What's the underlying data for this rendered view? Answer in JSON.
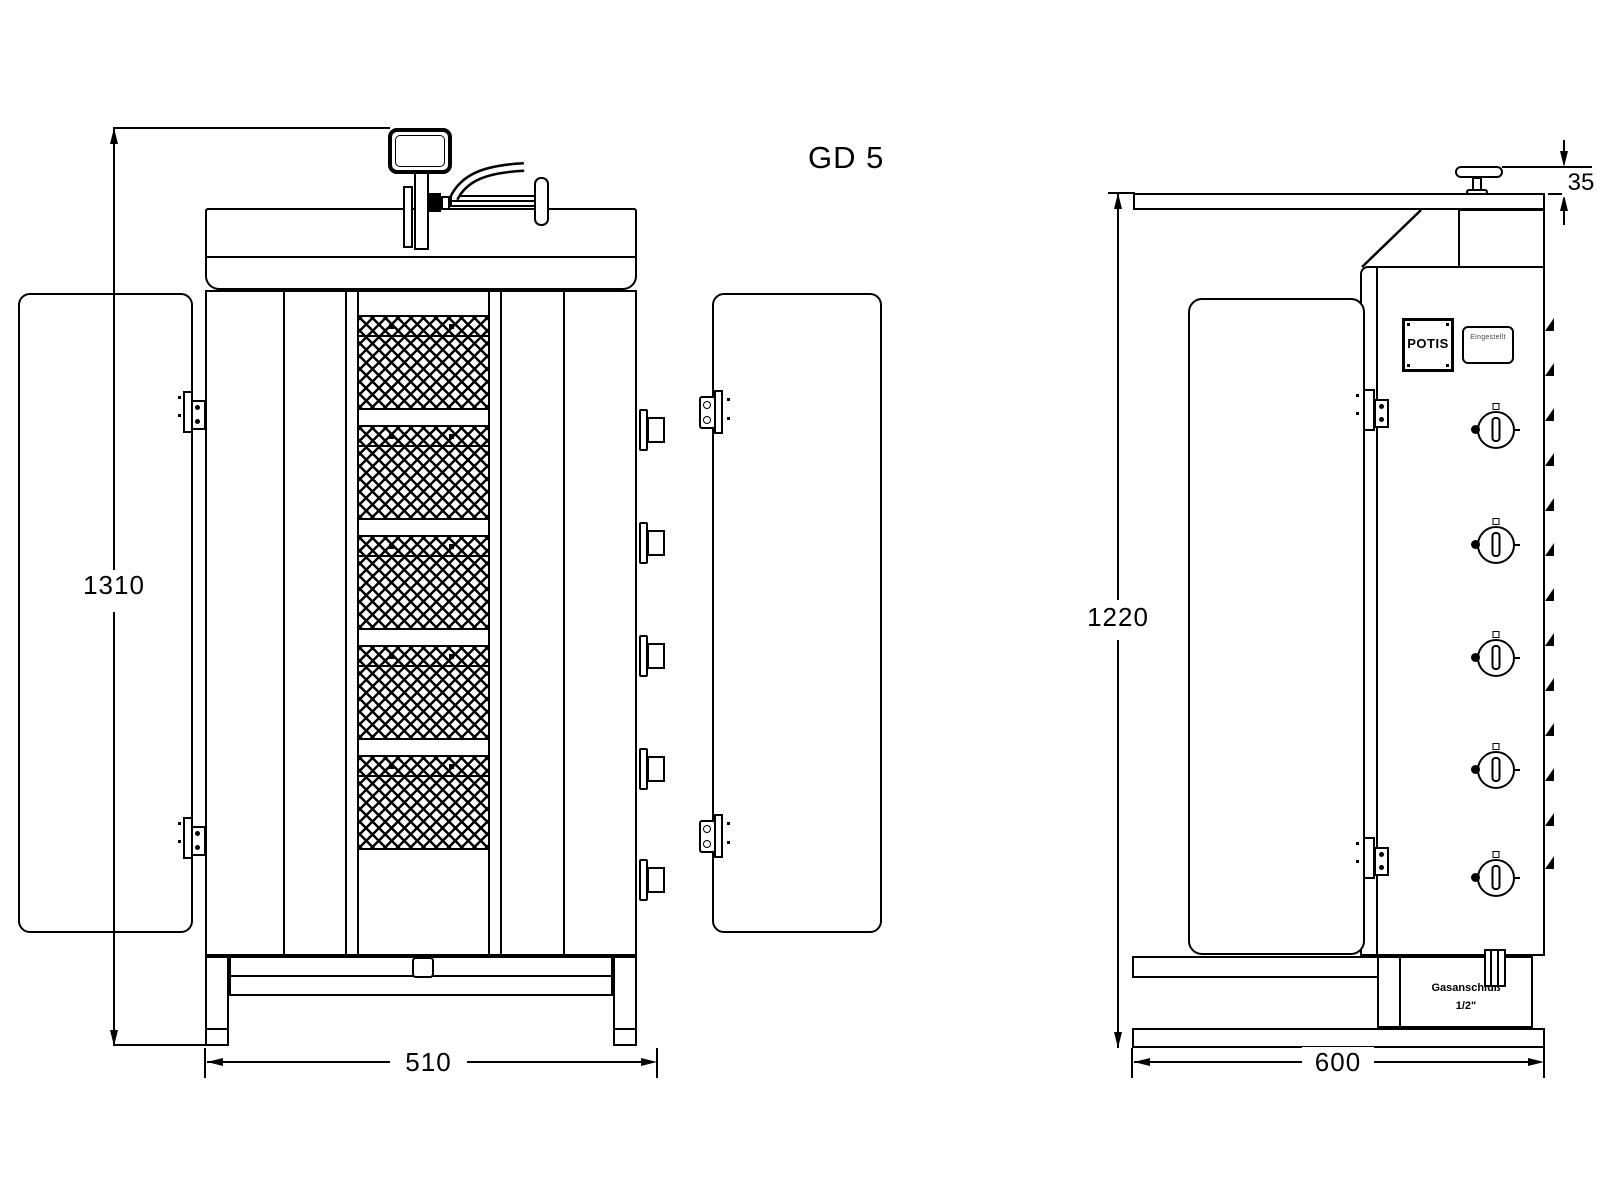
{
  "drawing": {
    "model_label": "GD 5"
  },
  "front_view": {
    "height_label": "1310",
    "width_label": "510"
  },
  "side_view": {
    "height_label": "1220",
    "width_label": "600",
    "handle_offset_label": "35",
    "brand_plate_label": "POTIS",
    "rating_plate_label": "Eingestellt",
    "gas_connection_line1": "Gasanschluß",
    "gas_connection_line2": "1/2\""
  }
}
